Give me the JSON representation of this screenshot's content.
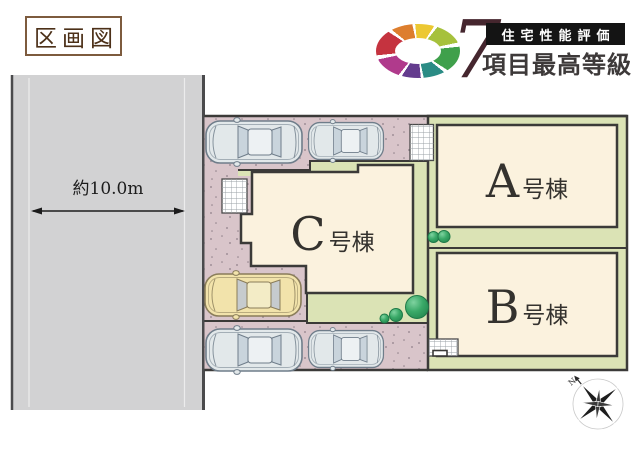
{
  "title": {
    "text": "区画図"
  },
  "badge": {
    "number": "7",
    "box_label": "住宅性能評価",
    "subtitle": "項目最高等級",
    "ring_colors": [
      "#c5333f",
      "#dd7e2e",
      "#ecc832",
      "#a6c13c",
      "#3fa04b",
      "#2b8c85",
      "#643c8e",
      "#b03a8c"
    ]
  },
  "road": {
    "width_label": "約10.0m"
  },
  "plot": {
    "buildings": [
      {
        "id": "a",
        "letter": "A",
        "suffix": "号棟"
      },
      {
        "id": "b",
        "letter": "B",
        "suffix": "号棟"
      },
      {
        "id": "c",
        "letter": "C",
        "suffix": "号棟"
      }
    ]
  },
  "compass": {
    "north_label": "N"
  },
  "colors": {
    "parking": "#d9c5ca",
    "landscape": "#dbe3b5",
    "building_fill": "#fbf2de",
    "outline": "#3b3a38",
    "road_fill": "#d2d2d3",
    "bush": "#2f9e5f"
  }
}
